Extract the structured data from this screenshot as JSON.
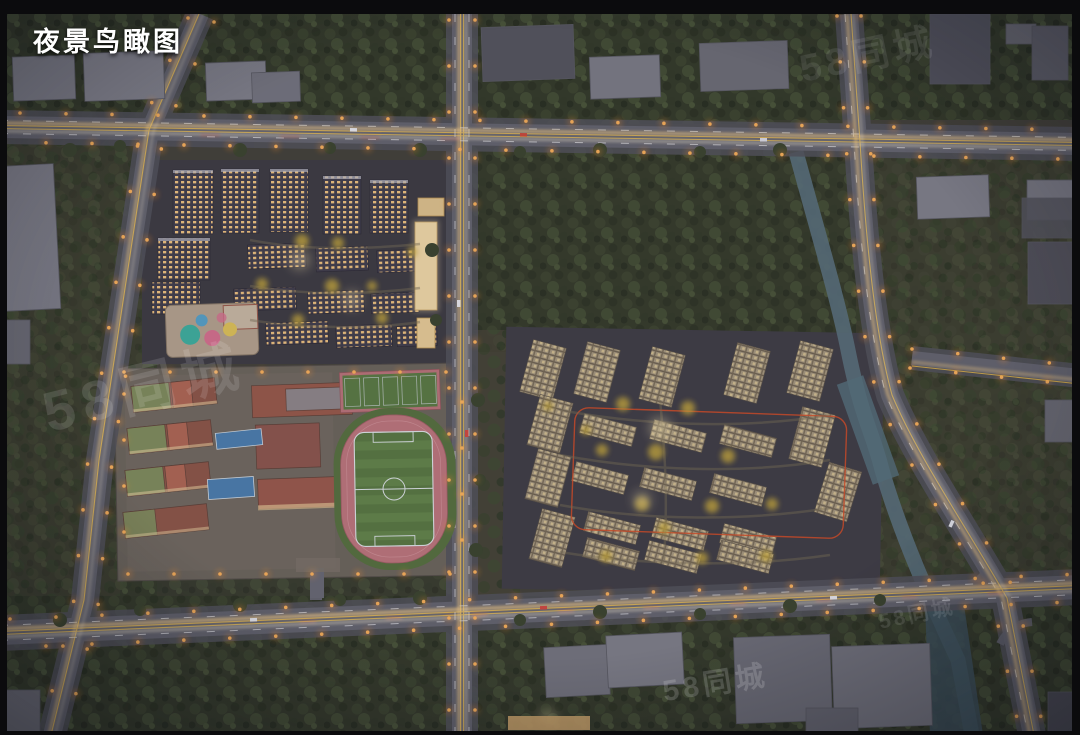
{
  "overlay": {
    "title": "夜景鸟瞰图"
  },
  "watermark": {
    "text": "58同城"
  },
  "palette": {
    "frame_black": "#0b0b0d",
    "ground_dark": "#44423a",
    "tree_canopy": "#3a422e",
    "road_surface": "#64646e",
    "lane_yellow": "#d7ae4a",
    "lane_white": "#d5d5db",
    "streetlight_orange": "#ff9d45",
    "light_trail_warm": "#ffd488",
    "window_light_warm": "#eec27f",
    "tower_facade_beige": "#a5977e",
    "track_pink": "#bc767c",
    "field_green": "#5a7843",
    "court_blue": "#4c7dad",
    "canal_blue": "#5a707b",
    "school_brick": "#8d5648",
    "boundary_orange": "#d14e28"
  }
}
